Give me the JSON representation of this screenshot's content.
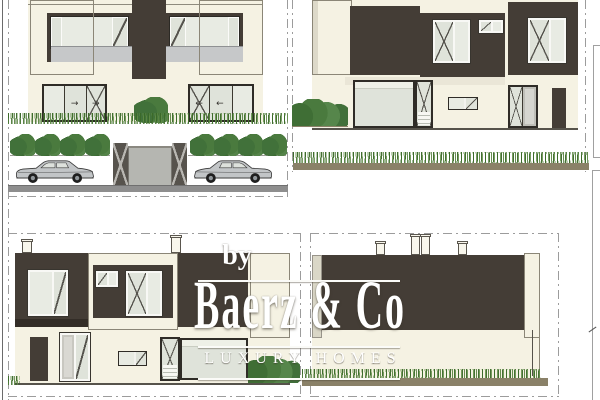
{
  "watermark": {
    "prefix": "by",
    "brand": "Baerz & Co",
    "tagline": "LUXURY HOMES"
  },
  "glyphs": {
    "arrow_right": "→",
    "arrow_left": "←"
  },
  "scene": {
    "sheet": "four black-and-cream architectural elevation drawings of a modern two-storey villa",
    "elevations": [
      "front elevation with balcony, glass doors, entrance gate, shrub row and two parked cars",
      "right side elevation with bush and grass strip",
      "left side elevation with two chimneys, entry door and bush",
      "rear elevation with four chimneys and grass strip"
    ],
    "car_count": 2,
    "street_shrub_count": 8,
    "chimney_count": 6
  },
  "colors": {
    "cream_wall": "#f5f2e3",
    "dark_cladding": "#443d36",
    "glass": "#dfe3da",
    "glass_light": "#e8ebe3",
    "balcony_rail": "#c6c8c9",
    "gate_panel": "#b5b6b1",
    "gate_pillar": "#57534d",
    "road": "#8e8e8e",
    "soil_strip": "#8a8168",
    "grass_green": "#4c7c3a",
    "shrub_green": "#41703a",
    "frame_line": "#9c9c9c",
    "watermark_text": "#ffffff",
    "car_body": "#c2c5c7",
    "outline_dark": "#3a3a3a"
  }
}
